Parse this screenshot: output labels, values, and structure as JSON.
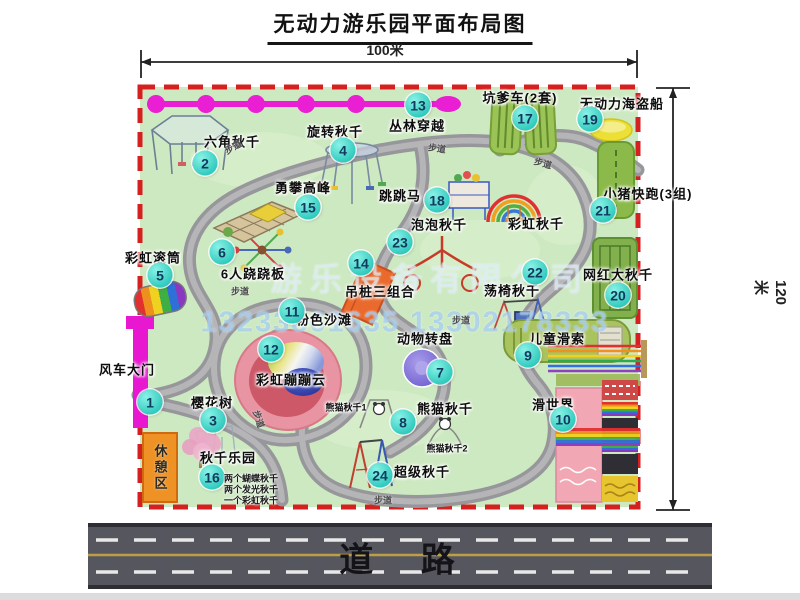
{
  "title": "无动力游乐园平面布局图",
  "dimensions": {
    "width": "100米",
    "height": "120米"
  },
  "road": {
    "label": "道 路"
  },
  "watermark": {
    "company": "游乐设备有限公司",
    "phone": "13233861635 13302178333"
  },
  "rest_area": {
    "label": "休憩区"
  },
  "path_label_text": "步道",
  "path_labels": [
    {
      "x": 233,
      "y": 147,
      "r": -30
    },
    {
      "x": 437,
      "y": 148,
      "r": 8
    },
    {
      "x": 543,
      "y": 163,
      "r": 15
    },
    {
      "x": 240,
      "y": 291,
      "r": 0
    },
    {
      "x": 259,
      "y": 419,
      "r": 72
    },
    {
      "x": 383,
      "y": 500,
      "r": 0
    },
    {
      "x": 461,
      "y": 320,
      "r": 0
    }
  ],
  "attractions": [
    {
      "num": "1",
      "label": "风车大门",
      "bx": 150,
      "by": 402,
      "lx": 127,
      "ly": 369
    },
    {
      "num": "2",
      "label": "六角秋千",
      "bx": 205,
      "by": 163,
      "lx": 232,
      "ly": 141
    },
    {
      "num": "3",
      "label": "樱花树",
      "bx": 213,
      "by": 420,
      "lx": 212,
      "ly": 402
    },
    {
      "num": "4",
      "label": "旋转秋千",
      "bx": 343,
      "by": 150,
      "lx": 335,
      "ly": 131
    },
    {
      "num": "5",
      "label": "彩虹滚筒",
      "bx": 160,
      "by": 275,
      "lx": 153,
      "ly": 257
    },
    {
      "num": "6",
      "label": "6人跷跷板",
      "bx": 222,
      "by": 252,
      "lx": 253,
      "ly": 273
    },
    {
      "num": "7",
      "label": "动物转盘",
      "bx": 440,
      "by": 372,
      "lx": 425,
      "ly": 338
    },
    {
      "num": "8",
      "label": "熊猫秋千",
      "bx": 403,
      "by": 422,
      "lx": 445,
      "ly": 408
    },
    {
      "num": "9",
      "label": "儿童滑索",
      "bx": 528,
      "by": 355,
      "lx": 557,
      "ly": 338
    },
    {
      "num": "10",
      "label": "滑世界",
      "bx": 563,
      "by": 419,
      "lx": 553,
      "ly": 404
    },
    {
      "num": "11",
      "label": "粉色沙滩",
      "bx": 292,
      "by": 311,
      "lx": 324,
      "ly": 319
    },
    {
      "num": "12",
      "label": "彩虹蹦蹦云",
      "bx": 271,
      "by": 349,
      "lx": 291,
      "ly": 379
    },
    {
      "num": "13",
      "label": "丛林穿越",
      "bx": 418,
      "by": 105,
      "lx": 417,
      "ly": 125
    },
    {
      "num": "14",
      "label": "吊桩三组合",
      "bx": 361,
      "by": 263,
      "lx": 380,
      "ly": 291
    },
    {
      "num": "15",
      "label": "勇攀高峰",
      "bx": 308,
      "by": 207,
      "lx": 303,
      "ly": 187
    },
    {
      "num": "16",
      "label": "秋千乐园",
      "bx": 212,
      "by": 477,
      "lx": 228,
      "ly": 457
    },
    {
      "num": "17",
      "label": "坑爹车(2套)",
      "bx": 525,
      "by": 118,
      "lx": 520,
      "ly": 97
    },
    {
      "num": "18",
      "label": "跳跳马",
      "bx": 437,
      "by": 200,
      "lx": 400,
      "ly": 195
    },
    {
      "num": "19",
      "label": "无动力海盗船",
      "bx": 590,
      "by": 119,
      "lx": 622,
      "ly": 103
    },
    {
      "num": "20",
      "label": "网红大秋千",
      "bx": 618,
      "by": 295,
      "lx": 618,
      "ly": 274
    },
    {
      "num": "21",
      "label": "小猪快跑(3组)",
      "bx": 603,
      "by": 210,
      "lx": 648,
      "ly": 193
    },
    {
      "num": "22",
      "label": "荡椅秋千",
      "bx": 535,
      "by": 272,
      "lx": 512,
      "ly": 290
    },
    {
      "num": "23",
      "label": "泡泡秋千",
      "bx": 400,
      "by": 242,
      "lx": 439,
      "ly": 224
    },
    {
      "num": "24",
      "label": "超级秋千",
      "bx": 380,
      "by": 475,
      "lx": 422,
      "ly": 471
    },
    {
      "num": null,
      "label": "彩虹秋千",
      "bx": 0,
      "by": 0,
      "lx": 536,
      "ly": 223
    }
  ],
  "sub_labels": [
    {
      "text": "熊猫秋千1",
      "x": 346,
      "y": 407
    },
    {
      "text": "熊猫秋千2",
      "x": 447,
      "y": 448
    }
  ],
  "swing_park_details": [
    {
      "text": "两个蝴蝶秋千"
    },
    {
      "text": "两个发光秋千"
    },
    {
      "text": "一个彩虹秋千"
    }
  ],
  "colors": {
    "border_red": "#d61f1f",
    "park_green": "#cde9c1",
    "badge_teal": "#2ec9bd",
    "zipline_magenta": "#ea1ed2",
    "road_gray": "#56565e"
  }
}
